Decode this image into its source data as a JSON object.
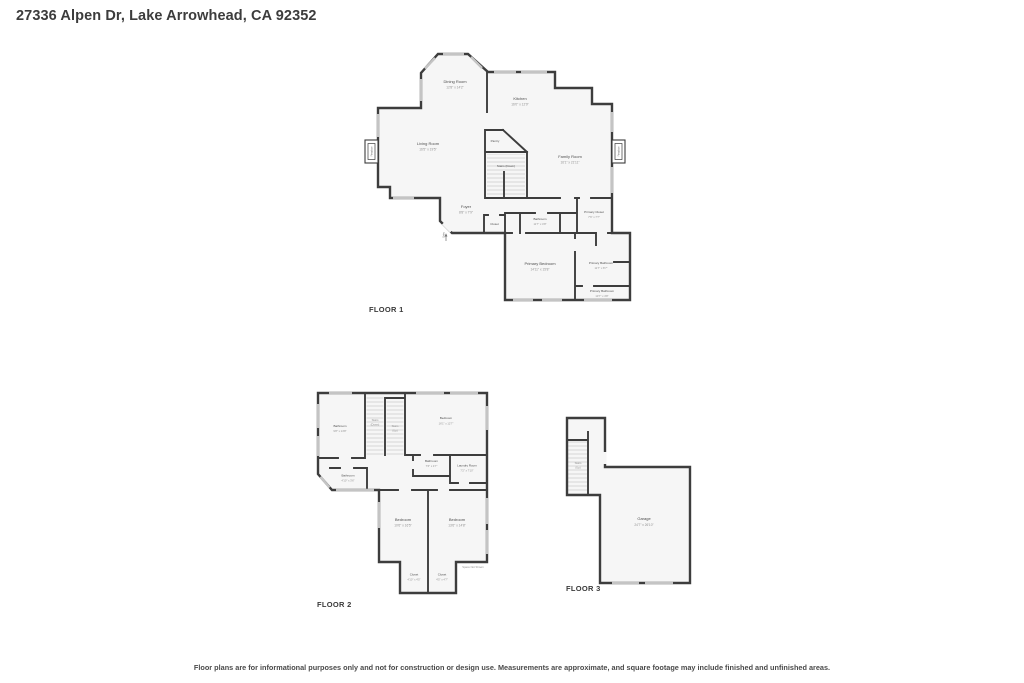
{
  "page": {
    "title": "27336 Alpen Dr, Lake Arrowhead, CA 92352",
    "disclaimer": "Floor plans are for informational purposes only and not for construction or design use. Measurements are approximate, and square footage may include finished and unfinished areas."
  },
  "colors": {
    "wall": "#3d3d3d",
    "room_fill": "#f6f6f6",
    "window": "#c4c4c4",
    "room_name": "#4e4e4e",
    "room_dims": "#929292"
  },
  "floor1": {
    "label": "FLOOR 1",
    "rooms": {
      "dining": {
        "name": "Dining Room",
        "dims": "12'8\" x 14'2\""
      },
      "kitchen": {
        "name": "Kitchen",
        "dims": "16'0\" x 12'9\""
      },
      "living": {
        "name": "Living Room",
        "dims": "16'5\" x 19'5\""
      },
      "family": {
        "name": "Family Room",
        "dims": "16'1\" x 21'11\""
      },
      "pantry": {
        "name": "Pantry"
      },
      "stairs_down": {
        "name": "Stairs (Down)"
      },
      "foyer": {
        "name": "Foyer",
        "dims": "8'8\" x 7'9\""
      },
      "closet": {
        "name": "Closet"
      },
      "bathroom": {
        "name": "Bathroom",
        "dims": "11'7\" x 4'8\""
      },
      "primary_closet": {
        "name": "Primary Closet",
        "dims": "7'6\" x 7'7\""
      },
      "primary_bedroom": {
        "name": "Primary Bedroom",
        "dims": "14'11\" x 15'8\""
      },
      "primary_bathroom": {
        "name": "Primary Bathroom",
        "dims": "11'7\" x 8'7\""
      },
      "primary_bathroom2": {
        "name": "Primary Bathroom",
        "dims": "13'7\" x 4'8\""
      },
      "fireplace_left": {
        "name": "Fireplace"
      },
      "fireplace_right": {
        "name": "Fireplace"
      },
      "entry": {
        "name": "Entry"
      }
    }
  },
  "floor2": {
    "label": "FLOOR 2",
    "rooms": {
      "bathroom_tl": {
        "name": "Bathroom",
        "dims": "9'8\" x 14'8\""
      },
      "stairs_down": {
        "name": "Stairs",
        "name2": "(Down)"
      },
      "stairs_up": {
        "name": "Stairs",
        "name2": "(Up)"
      },
      "bedroom_tr": {
        "name": "Bedroom",
        "dims": "16'1\" x 12'7\""
      },
      "bathroom_mid": {
        "name": "Bathroom",
        "dims": "7'6\" x 4'7\""
      },
      "laundry": {
        "name": "Laundry Room",
        "dims": "7'2\" x 7'10\""
      },
      "bathroom_sm": {
        "name": "Bathroom",
        "dims": "4'10\" x 3'6\""
      },
      "bedroom_ll": {
        "name": "Bedroom",
        "dims": "10'6\" x 16'5\""
      },
      "bedroom_lr": {
        "name": "Bedroom",
        "dims": "13'6\" x 14'8\""
      },
      "closet_l": {
        "name": "Closet",
        "dims": "4'10\" x 4'5\""
      },
      "closet_r": {
        "name": "Closet",
        "dims": "4'5\" x 4'7\""
      },
      "space_note": {
        "name": "Space Not Shown"
      }
    }
  },
  "floor3": {
    "label": "FLOOR 3",
    "rooms": {
      "stairs_up": {
        "name": "Stairs",
        "name2": "(Up)"
      },
      "garage": {
        "name": "Garage",
        "dims": "24'7\" x 26'10\""
      }
    }
  }
}
